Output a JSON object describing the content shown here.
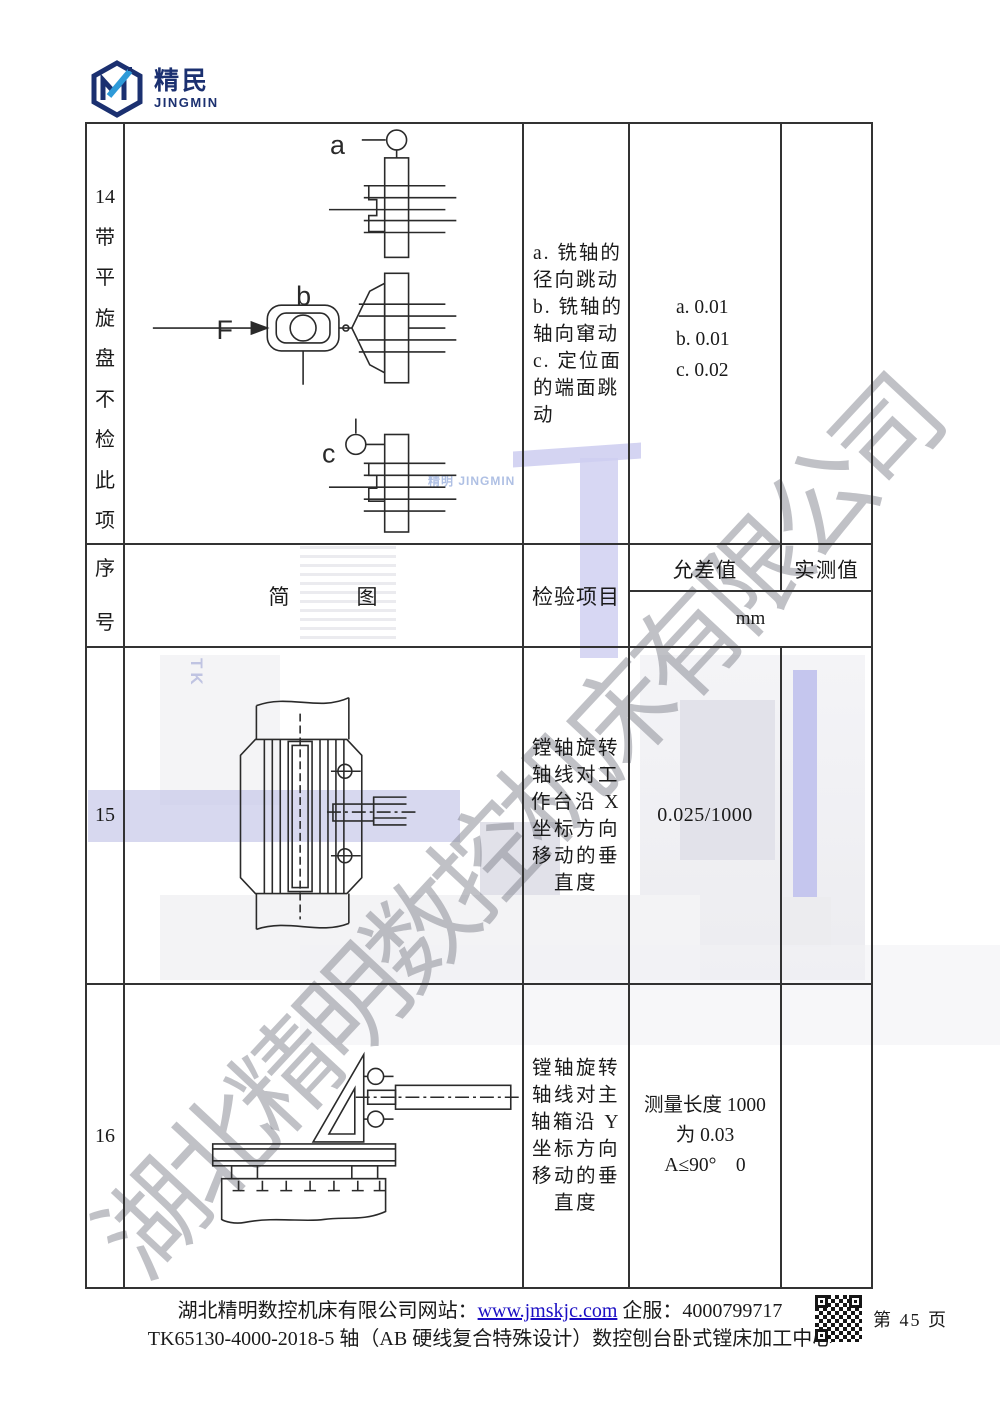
{
  "logo": {
    "brand_cn": "精民",
    "brand_en": "JINGMIN"
  },
  "watermark": {
    "text": "湖北精明数控机床有限公司"
  },
  "background": {
    "brand": "精明 JINGMIN",
    "model_code": "TK"
  },
  "colors": {
    "navy": "#1b3070",
    "light_blue": "#2e9ad8",
    "link_blue": "#1a0dc4",
    "border": "#333333",
    "watermark_gray": "#82848e",
    "lavender": "#c9cbe9"
  },
  "table": {
    "row14": {
      "seq_and_note": "14\n带\n平\n旋\n盘\n不\n检\n此\n项",
      "diagram_labels": {
        "a": "a",
        "b": "b",
        "c": "c",
        "force": "F"
      },
      "item": "a. 铣轴的\n径向跳动\nb. 铣轴的\n轴向窜动\nc. 定位面\n的端面跳\n动",
      "tolerance": "a. 0.01\nb. 0.01\nc. 0.02",
      "measured": ""
    },
    "header": {
      "seq": "序\n号",
      "diagram": "简　　　图",
      "item": "检验项目",
      "tolerance": "允差值",
      "measured": "实测值",
      "unit": "mm"
    },
    "row15": {
      "seq": "15",
      "item": "镗轴旋转\n轴线对工\n作台沿 X\n坐标方向\n移动的垂\n直度",
      "tolerance": "0.025/1000",
      "measured": ""
    },
    "row16": {
      "seq": "16",
      "item": "镗轴旋转\n轴线对主\n轴箱沿 Y\n坐标方向\n移动的垂\n直度",
      "tolerance": "测量长度 1000\n为 0.03\nA≤90°　0",
      "measured": ""
    }
  },
  "footer": {
    "site_label": "湖北精明数控机床有限公司网站：",
    "site_url": "www.jmskjc.com",
    "service": " 企服：4000799717",
    "product_line": "TK65130-4000-2018-5 轴（AB 硬线复合特殊设计）数控刨台卧式镗床加工中心",
    "page_number": "第 45 页"
  }
}
